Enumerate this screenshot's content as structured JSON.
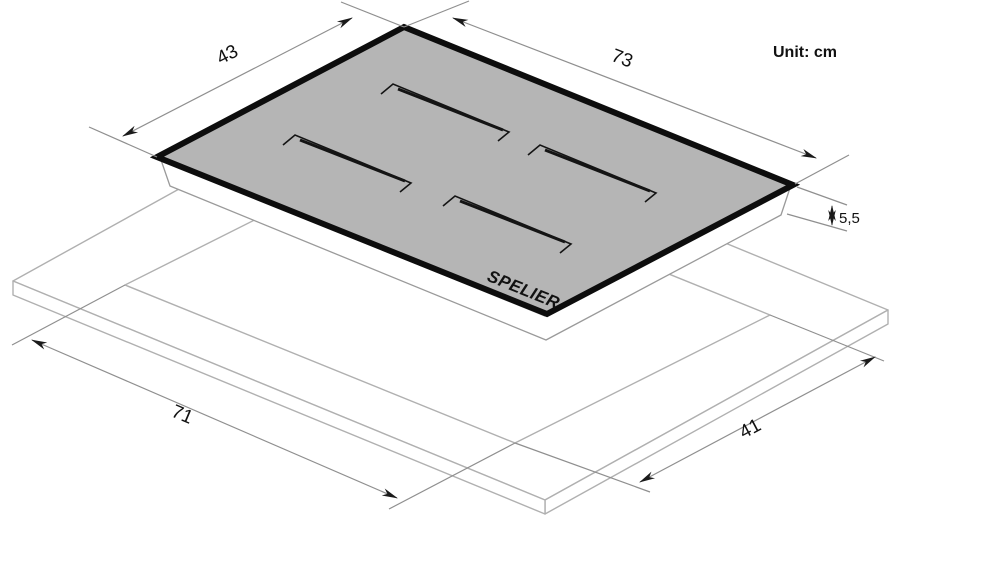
{
  "unit_label": "Unit: cm",
  "dimensions": {
    "hob_width": "43",
    "hob_length": "73",
    "hob_height": "5,5",
    "cutout_length": "71",
    "cutout_width": "41"
  },
  "brand": {
    "name": "SPELIER",
    "tagline": "GERMANY"
  },
  "colors": {
    "glass_gray": "#b5b5b5",
    "edge_black": "#0d0d0d",
    "outline_gray": "#b0b0b0",
    "body_outline_gray": "#9a9a9a",
    "dimension_gray": "#8f8f8f",
    "text_black": "#111111"
  }
}
